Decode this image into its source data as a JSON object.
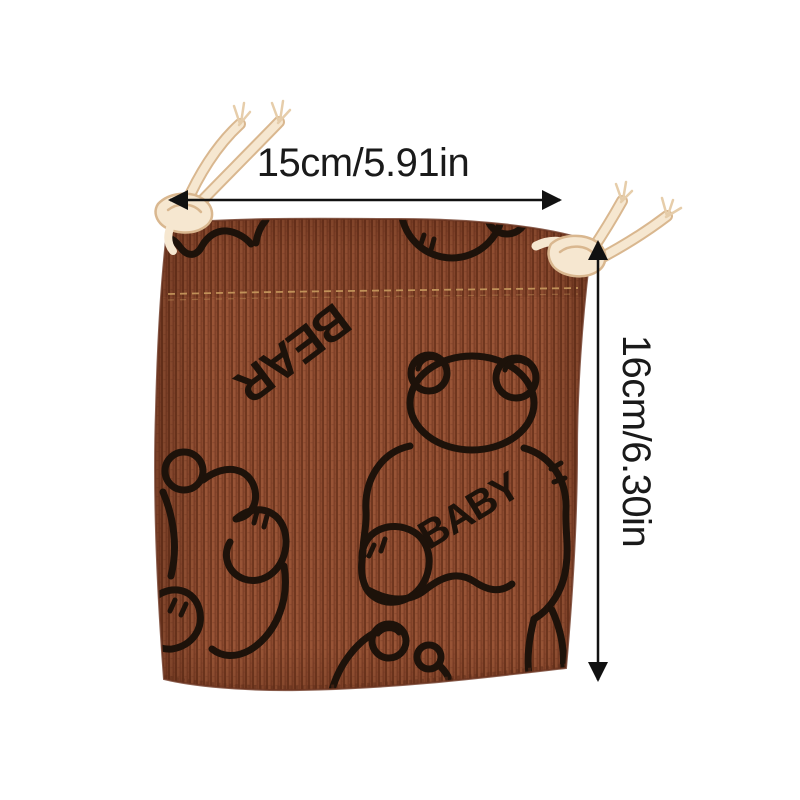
{
  "image": {
    "background_color": "#ffffff",
    "subject": "Brown corduroy drawstring pouch with cartoon bear print and size annotations",
    "dimension_labels": {
      "width": "15cm/5.91in",
      "height": "16cm/6.30in"
    },
    "print_words": {
      "bear": "BEAR",
      "baby": "BABY"
    },
    "colors": {
      "fabric_base": "#8c4a2f",
      "fabric_rib_dark": "#70371f",
      "fabric_rib_light": "#9d5939",
      "print_ink": "#1d120a",
      "stitch": "#c89a5e",
      "cord": "#f6e7d0",
      "cord_shadow": "#d9b78f",
      "arrow": "#111111",
      "label_text": "#1a1a1a"
    }
  }
}
